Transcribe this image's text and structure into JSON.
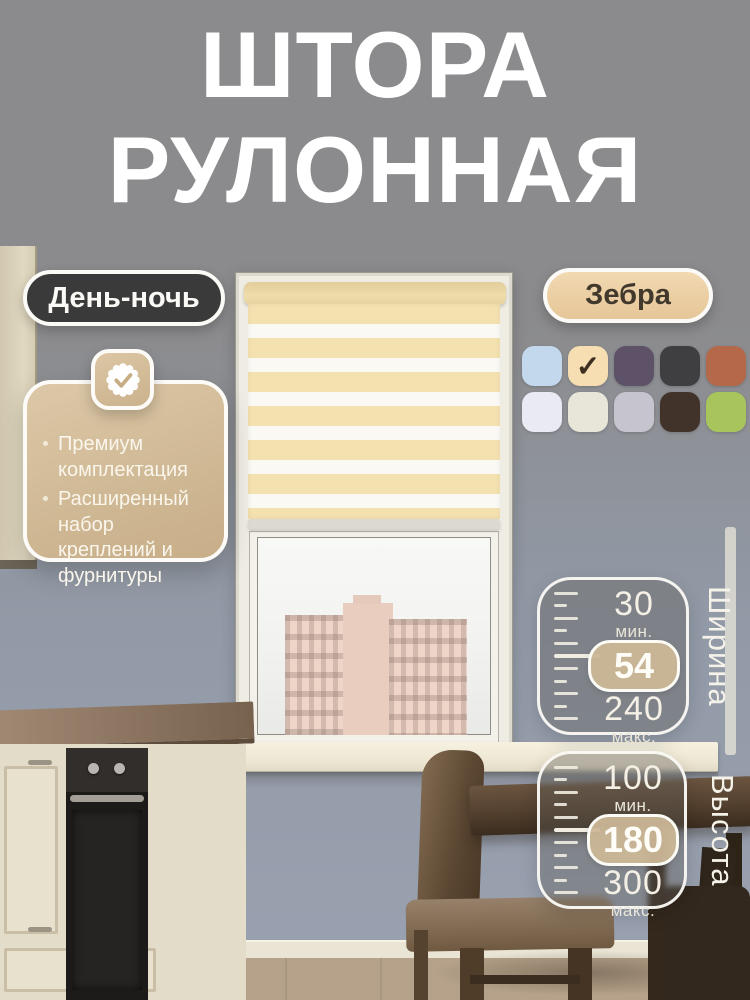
{
  "title": {
    "line1": "ШТОРА",
    "line2": "РУЛОННАЯ"
  },
  "tags": {
    "day_night": "День-ночь",
    "zebra": "Зебра"
  },
  "features": {
    "items": [
      "Премиум комплектация",
      "Расширенный набор креплений и фурнитуры"
    ]
  },
  "swatches": {
    "selected_index": 1,
    "colors": [
      "#c3d8ec",
      "#f6ddb2",
      "#5e5268",
      "#3f3e40",
      "#b4694a",
      "#e9eaf3",
      "#e7e6d9",
      "#c6c5cf",
      "#42332a",
      "#a8c45c"
    ]
  },
  "specs": {
    "width": {
      "label": "Ширина",
      "min": "30",
      "min_unit": "мин.",
      "value": "54",
      "max": "240",
      "max_unit": "макс."
    },
    "height": {
      "label": "Высота",
      "min": "100",
      "min_unit": "мин.",
      "value": "180",
      "max": "300",
      "max_unit": "макс."
    }
  },
  "icons": {
    "selected_check": "✓"
  },
  "accents": {
    "badge_dark": "#3b3a3b",
    "badge_beige": "#eccfa4",
    "card_beige_start": "#dcc8a7",
    "card_beige_end": "#c8ae88",
    "blind_stripe_beige": "#f4e1b0",
    "check_dark": "#3c2f1f",
    "text_white": "#ffffff"
  }
}
